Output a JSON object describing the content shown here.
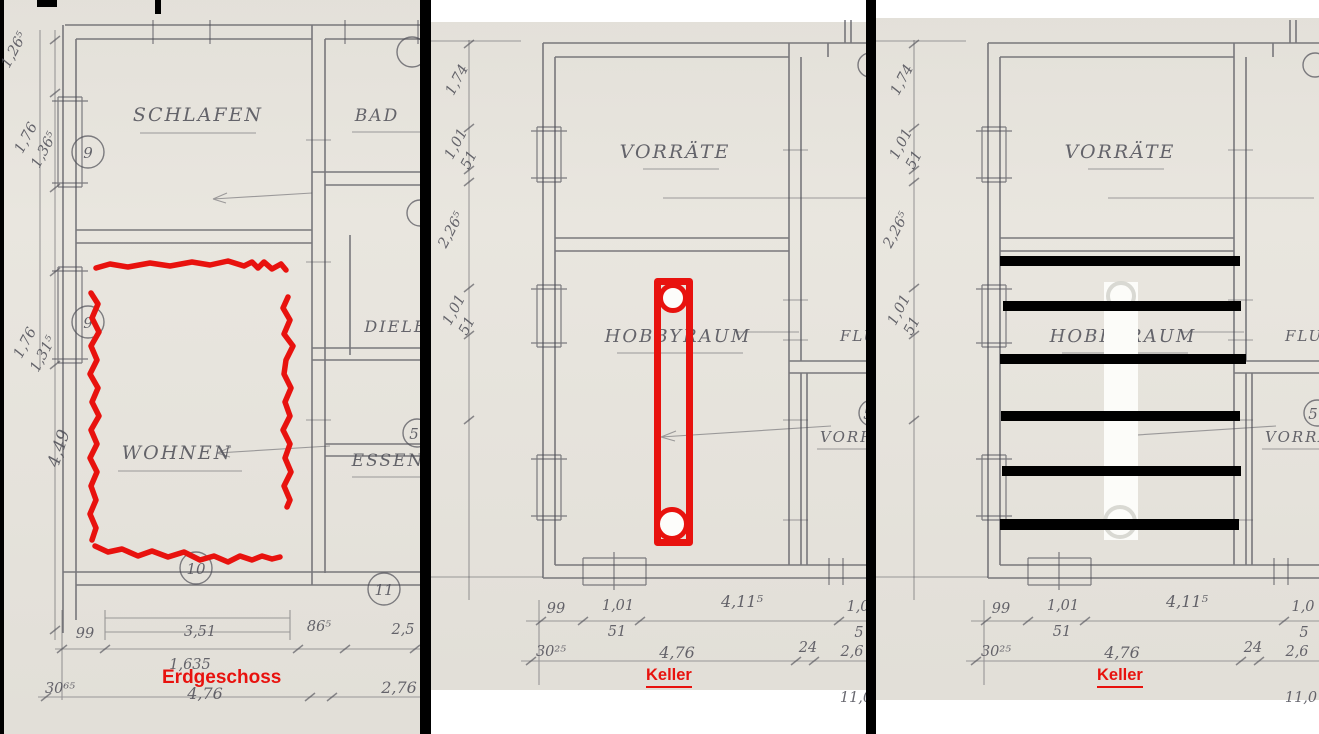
{
  "colors": {
    "paper": "#e9e6df",
    "paper2": "#edeae3",
    "pencil": "#4d4d56",
    "annotation_red": "#e8120e",
    "redaction_black": "#000000"
  },
  "erdgeschoss": {
    "caption": "Erdgeschoss",
    "rooms": {
      "schlafen": "SCHLAFEN",
      "bad": "BAD",
      "diele": "DIELE",
      "essen": "ESSEN",
      "wohnen": "WOHNEN"
    },
    "numbers": {
      "a": "9",
      "b": "9",
      "c": "10",
      "d": "11",
      "e": "5"
    },
    "dims_left": [
      "1,26⁵",
      "1,76",
      "1,36⁵",
      "1,76",
      "1,31⁵",
      "4,49"
    ],
    "dims_bottom1": [
      "99",
      "3,51",
      "86⁵",
      "2,5"
    ],
    "dims_bottom2": [
      "1,635"
    ],
    "dims_bottom3": [
      "30⁶⁵",
      "4,76",
      "2,76"
    ]
  },
  "keller": {
    "caption": "Keller",
    "rooms": {
      "vorraete": "VORRÄTE",
      "hobbyraum": "HOBBYRAUM",
      "flur": "FLUR",
      "vorrat": "VORRAT"
    },
    "numbers": {
      "n5": "5"
    },
    "dims_left": [
      "1,74",
      "1,01",
      "51",
      "2,26⁵",
      "1,01",
      "51"
    ],
    "dims_bottom1": [
      "99",
      "1,01",
      "51",
      "4,11⁵",
      "1,0",
      "5"
    ],
    "dims_bottom2": [
      "30²⁵",
      "4,76",
      "24",
      "2,6"
    ],
    "dims_bottom3": [
      "11,0"
    ]
  },
  "annotations": {
    "erdgeschoss_marking": "red freehand outline around WOHNEN",
    "keller1_marking": "red rectangle marker with two circles",
    "keller2_marking": "six black redaction bars over white strip"
  }
}
